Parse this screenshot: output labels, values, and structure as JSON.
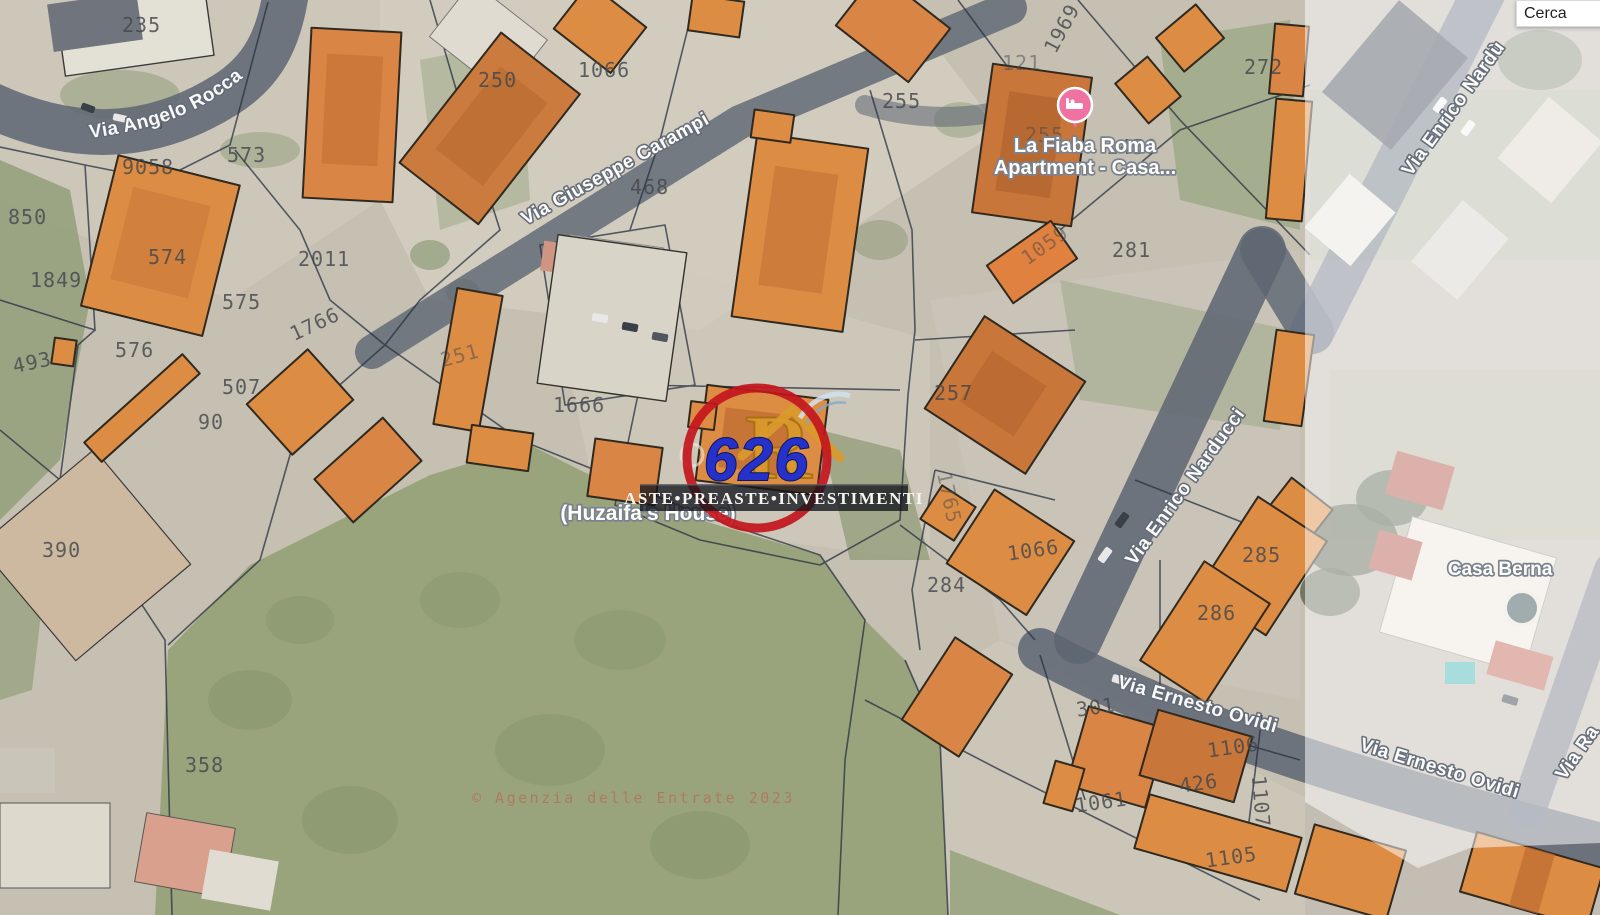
{
  "search": {
    "value": "Cerca"
  },
  "overlay_logo": {
    "number": "626",
    "monogram": "R",
    "brand": "ASTE•PREASTE•INVESTIMENTI",
    "ring_color": "#c3161c",
    "number_color": "#2531c9",
    "gold_color": "#d99a2b"
  },
  "map": {
    "attribution": "© Agenzia delle Entrate 2023",
    "building_color": "#dd8c44",
    "road_color": "#5d6572",
    "parcels": [
      "235",
      "9058",
      "573",
      "850",
      "1849",
      "574",
      "2011",
      "575",
      "576",
      "1766",
      "493",
      "507",
      "90",
      "250",
      "1066",
      "468",
      "255",
      "255",
      "1969",
      "121",
      "272",
      "1450",
      "281",
      "1059",
      "257",
      "1765",
      "1066",
      "284",
      "285",
      "286",
      "301",
      "1106",
      "426",
      "1107",
      "1061",
      "1105",
      "390",
      "358",
      "251",
      "1666"
    ],
    "streets": [
      "Via Angelo Rocca",
      "Via Giuseppe Carampi",
      "Via Enrico Nardù",
      "Via Enrico Narducci",
      "Via Ernesto Ovidi",
      "Via Ernesto Ovidi",
      "Via Ra"
    ],
    "pois": {
      "lodging_line1": "La Fiaba Roma",
      "lodging_line2": "Apartment - Casa...",
      "house": "(Huzaifa's House)",
      "casa_berna": "Casa Berna"
    }
  }
}
